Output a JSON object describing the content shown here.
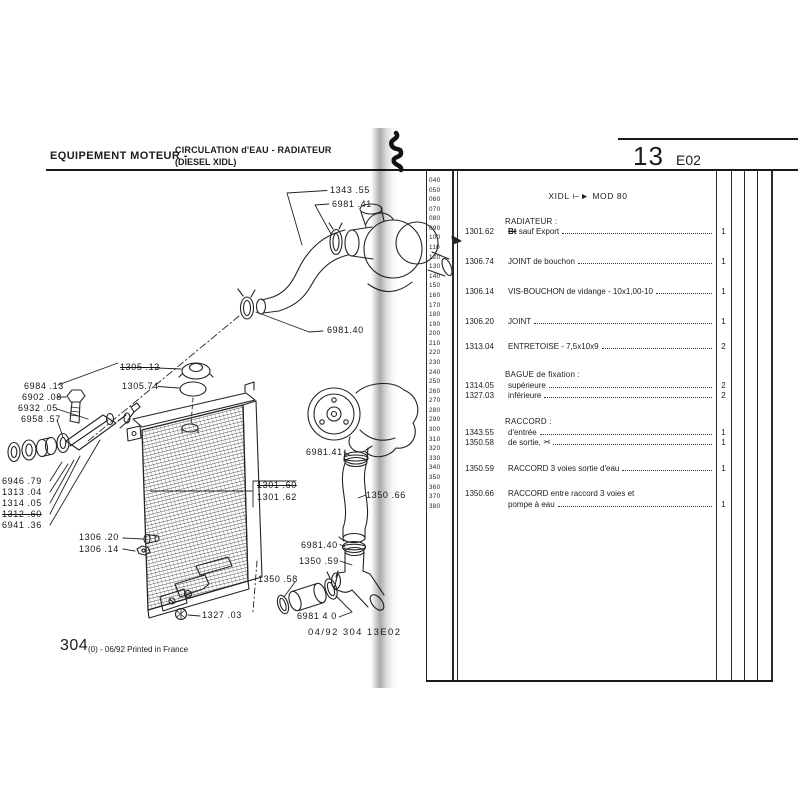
{
  "header": {
    "section_title": "EQUIPEMENT MOTEUR -",
    "subtitle_line1": "CIRCULATION d'EAU - RADIATEUR",
    "subtitle_line2": "(DIESEL XIDL)",
    "chapter_number": "13",
    "chapter_code": "E02"
  },
  "footer": {
    "page_number": "304",
    "page_note": "(0) - 06/92 Printed in France",
    "plate_ref": "04/92 304 13E02"
  },
  "table": {
    "model_range": "XIDL ⊢► MOD 80",
    "margin_numbers": [
      "040",
      "050",
      "060",
      "070",
      "080",
      "090",
      "100",
      "110",
      "120",
      "130",
      "140",
      "150",
      "160",
      "170",
      "180",
      "190",
      "200",
      "210",
      "220",
      "230",
      "240",
      "250",
      "260",
      "270",
      "280",
      "290",
      "300",
      "310",
      "320",
      "330",
      "340",
      "350",
      "360",
      "370",
      "380"
    ],
    "rows": [
      {
        "type": "section",
        "label": "RADIATEUR :"
      },
      {
        "type": "item",
        "ref": "1301.62",
        "pre": "Bt",
        "label": "sauf Export",
        "qty": "1"
      },
      {
        "type": "item",
        "ref": "1306.74",
        "label": "JOINT de bouchon",
        "qty": "1"
      },
      {
        "type": "item",
        "ref": "1306.14",
        "label": "VIS-BOUCHON de vidange - 10x1,00-10",
        "qty": "1"
      },
      {
        "type": "item",
        "ref": "1306.20",
        "label": "JOINT",
        "qty": "1"
      },
      {
        "type": "item",
        "ref": "1313.04",
        "label": "ENTRETOISE - 7,5x10x9",
        "qty": "2"
      },
      {
        "type": "section",
        "label": "BAGUE de fixation :"
      },
      {
        "type": "item",
        "ref": "1314.05",
        "label": "supérieure",
        "qty": "2"
      },
      {
        "type": "item",
        "ref": "1327.03",
        "label": "inférieure",
        "qty": "2"
      },
      {
        "type": "section",
        "label": "RACCORD :"
      },
      {
        "type": "item",
        "ref": "1343.55",
        "label": "d'entrée",
        "qty": "1"
      },
      {
        "type": "item",
        "ref": "1350.58",
        "label": "de sortie,",
        "icon": "✂",
        "qty": "1"
      },
      {
        "type": "item",
        "ref": "1350.59",
        "label": "RACCORD 3 voies sortie d'eau",
        "qty": "1"
      },
      {
        "type": "item",
        "ref": "1350.66",
        "label": "RACCORD entre raccord 3 voies et",
        "label2": "pompe à eau",
        "qty": "1"
      }
    ]
  },
  "diagram": {
    "labels": [
      {
        "text": "1343 .55"
      },
      {
        "text": "6981 .41"
      },
      {
        "text": "6981.40"
      },
      {
        "text": "1305 .12"
      },
      {
        "text": "1305.74"
      },
      {
        "text": "6984 .13"
      },
      {
        "text": "6902 .08"
      },
      {
        "text": "6932 .05"
      },
      {
        "text": "6958 .57"
      },
      {
        "text": "6946 .79"
      },
      {
        "text": "1313 .04"
      },
      {
        "text": "1314 .05"
      },
      {
        "text": "1312 .60"
      },
      {
        "text": "6941 .36"
      },
      {
        "text": "1301 .60"
      },
      {
        "text": "1301 .62"
      },
      {
        "text": "6981.41"
      },
      {
        "text": "1350 .66"
      },
      {
        "text": "1306 .20"
      },
      {
        "text": "1306 .14"
      },
      {
        "text": "6981.40"
      },
      {
        "text": "1350 .59"
      },
      {
        "text": "1350 .58"
      },
      {
        "text": "1327 .03"
      },
      {
        "text": "6981 4 0"
      }
    ]
  },
  "colors": {
    "ink": "#1c1c1c",
    "paper": "#ffffff",
    "fold_shadow": "#8f8f8f"
  }
}
